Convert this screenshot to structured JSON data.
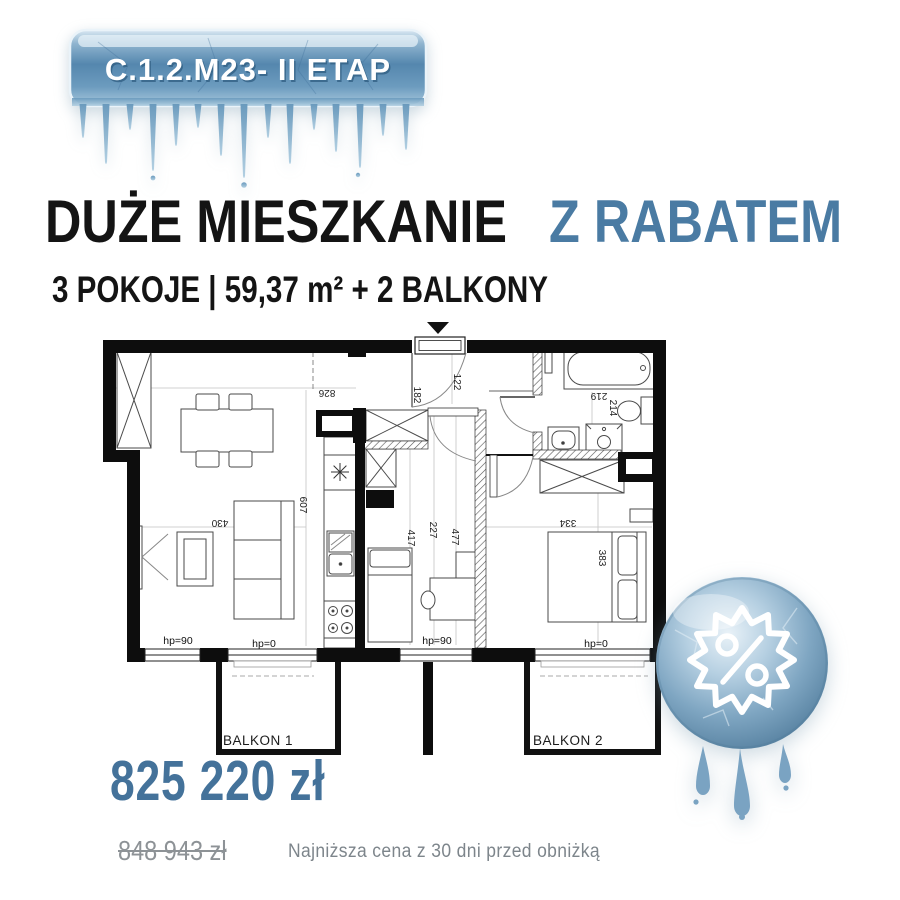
{
  "header": {
    "badge_label": "C.1.2.M23- II ETAP"
  },
  "title": {
    "main": "DUŻE MIESZKANIE",
    "accent": "Z RABATEM"
  },
  "subtitle": "3 POKOJE | 59,37 m² + 2 BALKONY",
  "floorplan": {
    "dims": {
      "hall": "826",
      "living_h": "607",
      "living_w": "430",
      "entry_a": "182",
      "entry_b": "122",
      "bath_a": "219",
      "bath_b": "214",
      "room2_a": "417",
      "room2_b": "227",
      "room2_c": "477",
      "bedroom_w": "334",
      "bedroom_h": "383"
    },
    "windows": {
      "w1": "hp=90",
      "w2": "hp=0",
      "w3": "hp=90",
      "w4": "hp=0"
    },
    "balcony1": "BALKON 1",
    "balcony2": "BALKON 2"
  },
  "pricing": {
    "current": "825 220 zł",
    "previous": "848 943 zł",
    "note": "Najniższa cena z 30 dni przed obniżką"
  },
  "colors": {
    "accent": "#4a7ba3",
    "price": "#44729a",
    "old_price": "#8d9296",
    "note": "#7d858b",
    "ink": "#141414",
    "ice_dark": "#4a7ca6",
    "ice_light": "#d9e8f2"
  }
}
